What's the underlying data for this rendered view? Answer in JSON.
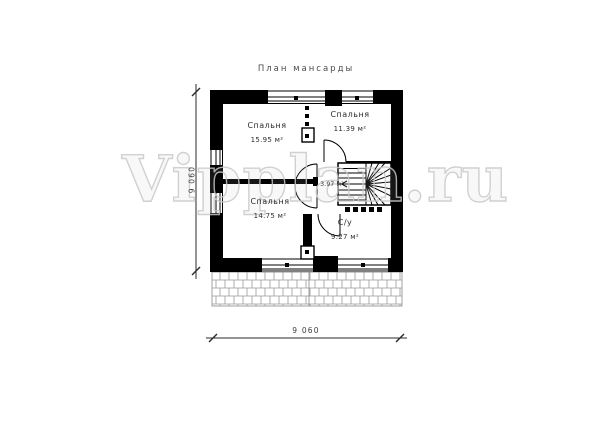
{
  "page": {
    "title": "План мансарды",
    "watermark": "Vipplan.ru"
  },
  "rooms": {
    "bedroom_top_left": {
      "name": "Спальня",
      "area": "15.95 м²"
    },
    "bedroom_top_right": {
      "name": "Спальня",
      "area": "11.39 м²"
    },
    "bedroom_bottom_left": {
      "name": "Спальня",
      "area": "14.75 м²"
    },
    "bathroom": {
      "name": "С/у",
      "area": "9.27 м²"
    },
    "hall": {
      "area": "3.97 м²"
    }
  },
  "dimensions": {
    "bottom_width": "9 060",
    "left_height": "9 060"
  },
  "colors": {
    "wall": "#000000",
    "line": "#1a1a1a",
    "label": "#2e2e2e",
    "dim_text": "#3c3c3c",
    "watermark_stroke": "#c9c9c9",
    "hatch_line": "#9a9a9a"
  }
}
